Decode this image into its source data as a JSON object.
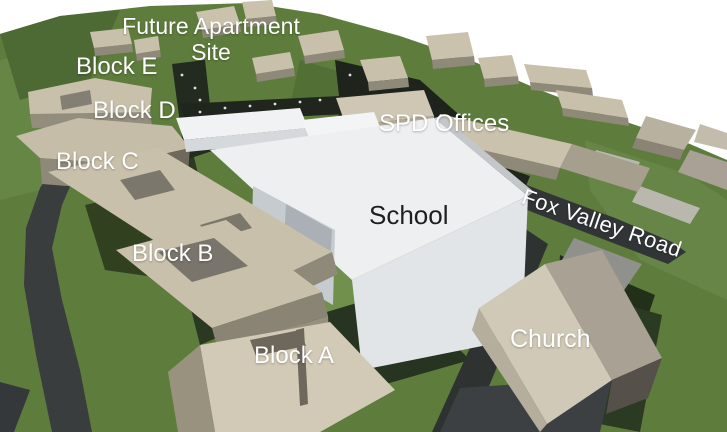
{
  "scene": {
    "type": "3d-site-massing-render",
    "description_visible_labels_only": true
  },
  "labels": {
    "future_apartment_site": "Future Apartment Site",
    "block_e": "Block E",
    "block_d": "Block D",
    "block_c": "Block C",
    "block_b": "Block B",
    "block_a": "Block A",
    "spd_offices": "SPD Offices",
    "school": "School",
    "fox_valley_road": "Fox Valley Road",
    "church": "Church"
  },
  "colors": {
    "sky": "#ffffff",
    "grass": "#5e7c3c",
    "grass_light": "#70904c",
    "grass_dark": "#4e6a34",
    "shadow_green": "#2b3923",
    "road": "#3a3d3e",
    "road_dark": "#2e3231",
    "tree_dark": "#20261e",
    "building_tan": "#c9c0ab",
    "building_tan_light": "#d2cab6",
    "building_tan_side": "#8f897a",
    "roof_gray": "#7c776d",
    "school_white": "#edeff1",
    "school_shade": "#c6cbcf",
    "church_roof": "#d0c9b7",
    "church_roof_dark": "#a9a193",
    "label_white": "#ffffff",
    "label_dark": "#1f1f1f"
  }
}
